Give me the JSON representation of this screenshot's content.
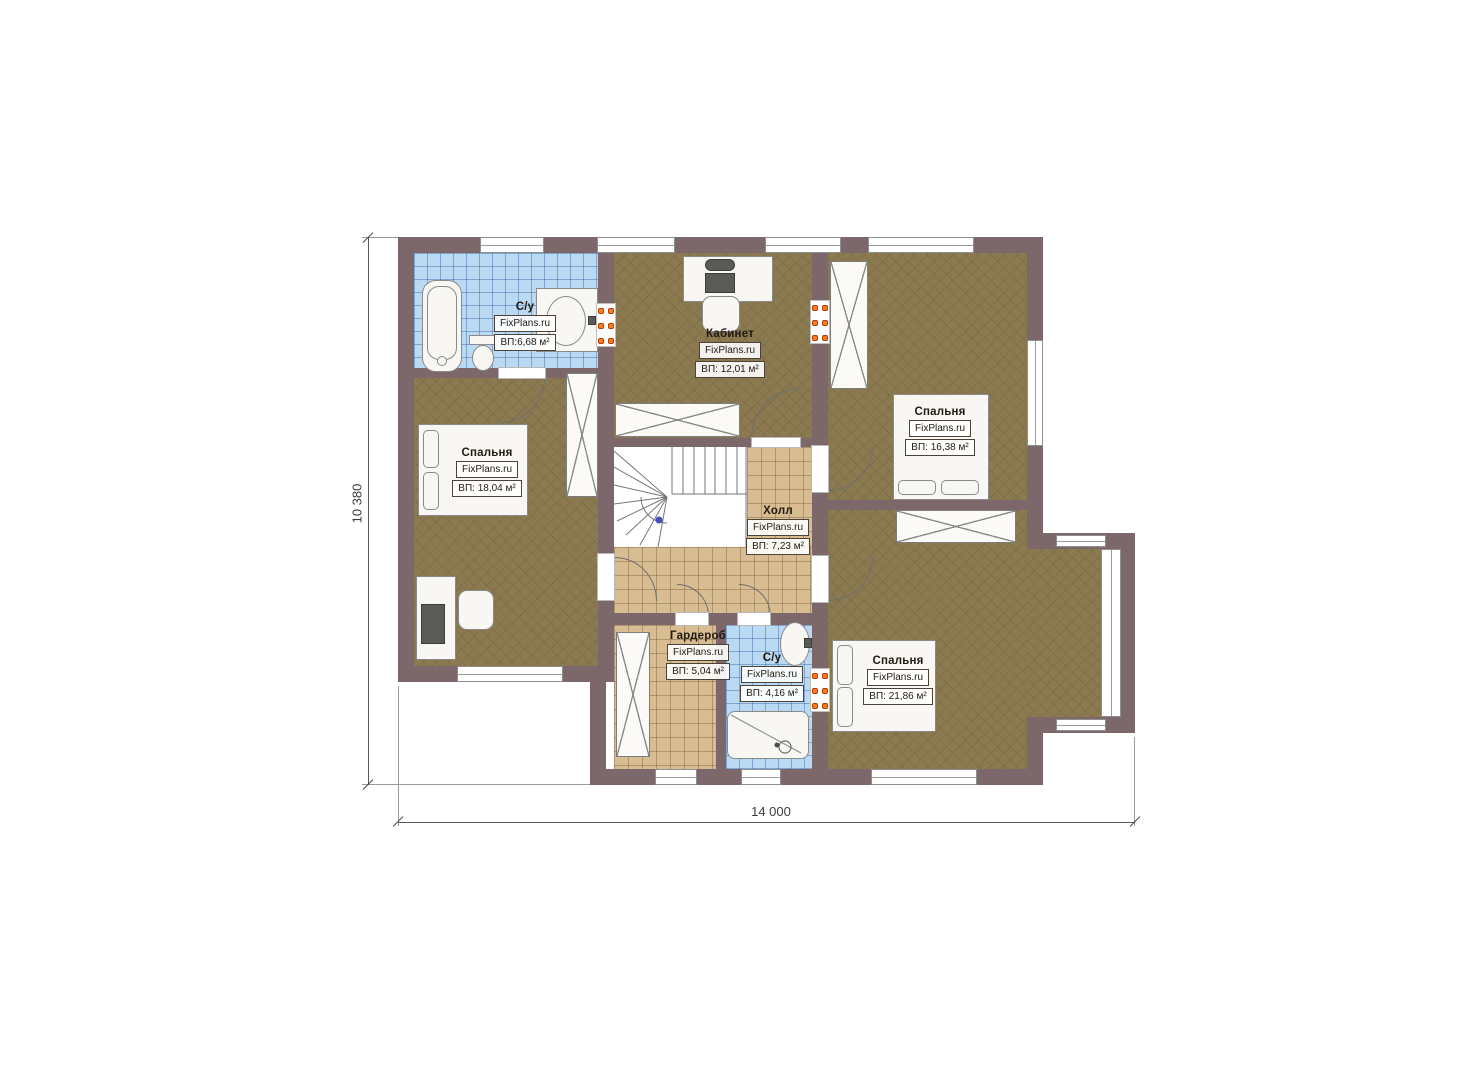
{
  "plan": {
    "title": "Floor plan – second floor",
    "brand": "FixPlans.ru",
    "rooms": [
      {
        "name": "С/у",
        "brand": "FixPlans.ru",
        "area": "ВП:6,68 м²"
      },
      {
        "name": "Кабинет",
        "brand": "FixPlans.ru",
        "area": "ВП: 12,01 м²"
      },
      {
        "name": "Спальня",
        "brand": "FixPlans.ru",
        "area": "ВП: 18,04 м²"
      },
      {
        "name": "Спальня",
        "brand": "FixPlans.ru",
        "area": "ВП: 16,38 м²"
      },
      {
        "name": "Холл",
        "brand": "FixPlans.ru",
        "area": "ВП: 7,23 м²"
      },
      {
        "name": "Гардероб",
        "brand": "FixPlans.ru",
        "area": "ВП: 5,04 м²"
      },
      {
        "name": "С/у",
        "brand": "FixPlans.ru",
        "area": "ВП: 4,16 м²"
      },
      {
        "name": "Спальня",
        "brand": "FixPlans.ru",
        "area": "ВП: 21,86 м²"
      }
    ],
    "dimensions": {
      "width": "14 000",
      "height": "10 380"
    },
    "colors": {
      "wall": "#7c686b",
      "floor_wood": "#8b7950",
      "tile_beige": "#d8bd93",
      "tile_blue": "#badaf3",
      "radiator": "#ff7c1f"
    }
  }
}
